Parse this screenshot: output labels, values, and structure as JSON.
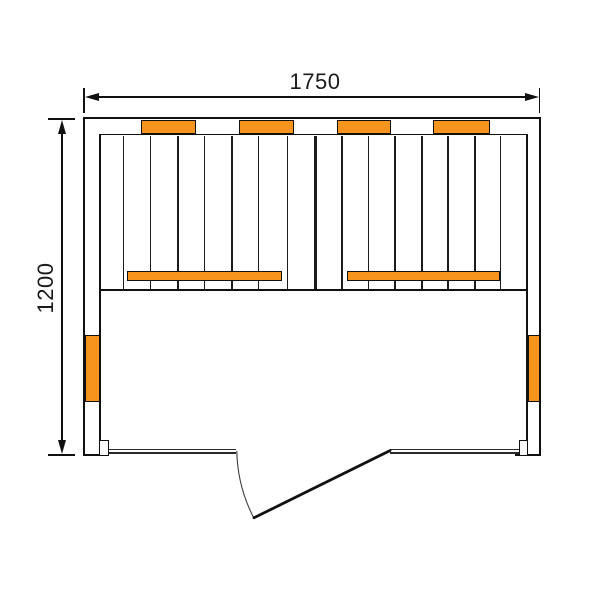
{
  "diagram": {
    "type": "floor-plan",
    "subject": "sauna cabin top view",
    "dimension_labels": {
      "width": "1750",
      "depth": "1200"
    },
    "colors": {
      "heater_orange": "#F7941D",
      "line": "#111111",
      "background": "#FFFFFF"
    },
    "components": {
      "back_wall_heaters": 4,
      "side_wall_heaters": 2,
      "bench_heater_strips": 2,
      "glass_front_panels": 2,
      "door_swing": "outward"
    }
  }
}
